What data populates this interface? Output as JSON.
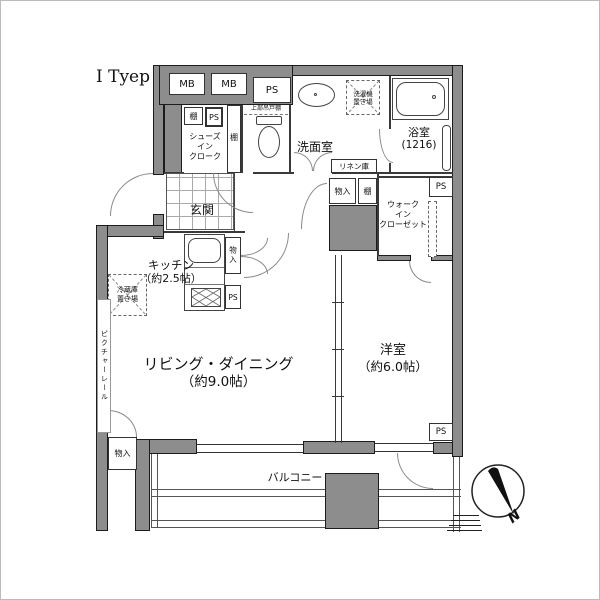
{
  "title": "I Tyep",
  "compass": {
    "north_label": "N"
  },
  "rooms": {
    "living": {
      "name": "リビング・ダイニング",
      "size": "（約9.0帖）"
    },
    "kitchen": {
      "name": "キッチン",
      "size": "（約2.5帖）"
    },
    "bedroom": {
      "name": "洋室",
      "size": "（約6.0帖）"
    },
    "washroom": {
      "name": "洗面室"
    },
    "bathroom": {
      "name": "浴室",
      "size": "(1216)"
    },
    "entrance": {
      "name": "玄関"
    },
    "balcony": {
      "name": "バルコニー"
    },
    "walk_in_closet": {
      "line1": "ウォーク",
      "line2": "イン",
      "line3": "クローゼット"
    },
    "shoes_in_closet": {
      "line1": "シューズ",
      "line2": "イン",
      "line3": "クローク"
    }
  },
  "fixtures": {
    "washer_line1": "洗濯機",
    "washer_line2": "置き場",
    "fridge_line1": "冷蔵庫",
    "fridge_line2": "置き場",
    "upper_cabinet": "上部吊戸棚",
    "linen": "リネン庫",
    "picture_rail": "ピクチャーレール"
  },
  "labels": {
    "mb": "MB",
    "ps": "PS",
    "shelf": "棚",
    "storage": "物入"
  },
  "colors": {
    "wall": "#8d8d8d",
    "line": "#3a3a3a"
  }
}
